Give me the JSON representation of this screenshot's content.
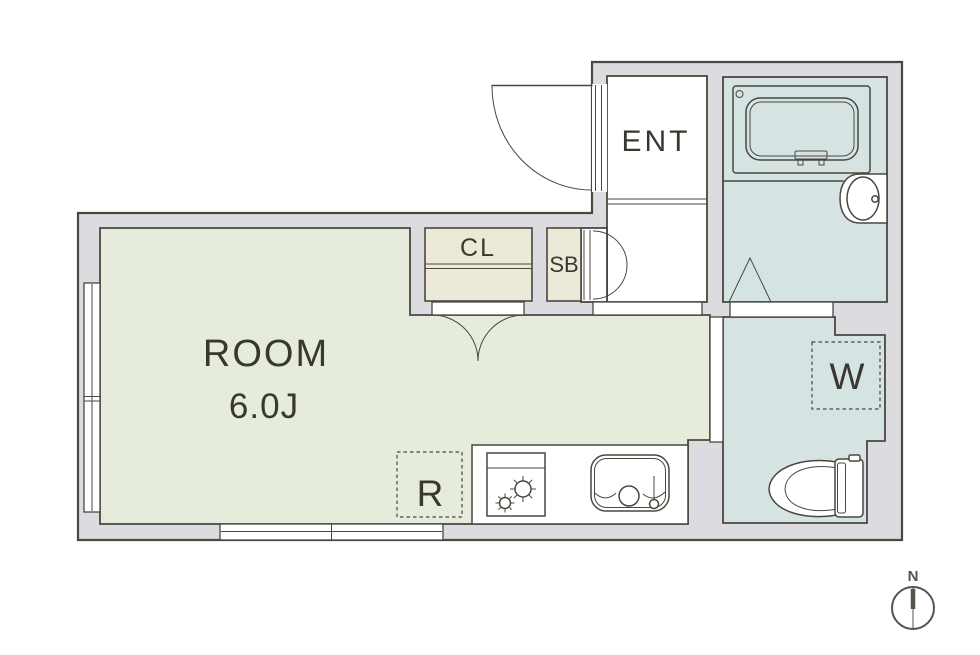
{
  "floor_plan": {
    "labels": {
      "entrance": "ENT",
      "closet": "CL",
      "shoe_box": "SB",
      "room_name": "ROOM",
      "room_size": "6.0J",
      "washer_space": "W",
      "refrigerator_space": "R",
      "compass_north": "N"
    },
    "colors": {
      "wall_fill": "#dcdce0",
      "room_floor": "#e5ecdc",
      "wet_area_floor": "#d5e3e3",
      "storage_fill": "#ede9d9",
      "line": "#4a473f",
      "text": "#3a372e",
      "compass": "#56524c"
    }
  }
}
